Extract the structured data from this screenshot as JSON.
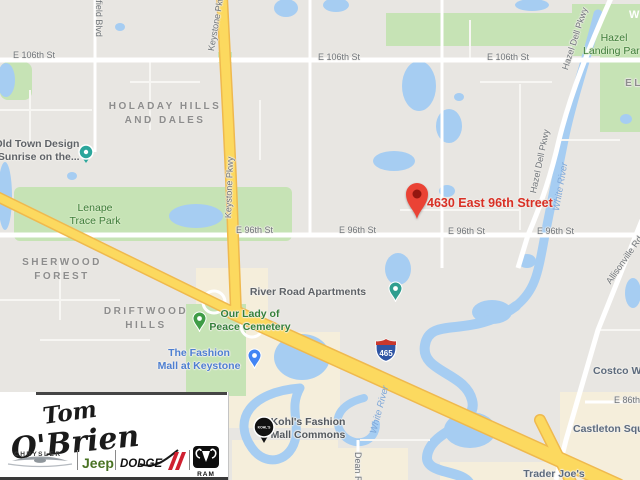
{
  "map": {
    "marker": {
      "label": "4630 East 96th Street",
      "pin_color": "#ea4335",
      "label_color": "#d93025"
    },
    "shield": {
      "route": "465"
    },
    "streets": [
      {
        "t": "E 106th St",
        "x": 13,
        "y": 50
      },
      {
        "t": "E 106th St",
        "x": 318,
        "y": 52
      },
      {
        "t": "E 106th St",
        "x": 487,
        "y": 52
      },
      {
        "t": "E 96th St",
        "x": 236,
        "y": 225
      },
      {
        "t": "E 96th St",
        "x": 339,
        "y": 225
      },
      {
        "t": "E 96th St",
        "x": 448,
        "y": 226
      },
      {
        "t": "E 96th St",
        "x": 537,
        "y": 226
      },
      {
        "t": "E 86th St",
        "x": 614,
        "y": 395
      },
      {
        "t": "Keystone Pkwy",
        "x": 206,
        "y": 50,
        "r": -80
      },
      {
        "t": "Keystone Pkwy",
        "x": 223,
        "y": 218,
        "r": -88
      },
      {
        "t": "Westfield Blvd",
        "x": 104,
        "y": -20,
        "r": 90
      },
      {
        "t": "Hazel Dell Pkwy",
        "x": 560,
        "y": 68,
        "r": -72
      },
      {
        "t": "Hazel Dell Pkwy",
        "x": 528,
        "y": 192,
        "r": -78
      },
      {
        "t": "Allisonville Rd",
        "x": 604,
        "y": 280,
        "r": -55
      },
      {
        "t": "Dean Rd",
        "x": 363,
        "y": 452,
        "r": 90
      }
    ],
    "waters": [
      {
        "t": "White River",
        "x": 551,
        "y": 210,
        "r": -80
      },
      {
        "t": "White River",
        "x": 368,
        "y": 432,
        "r": -75
      }
    ],
    "areas": [
      {
        "lines": [
          "HOLADAY HILLS",
          "AND DALES"
        ],
        "x": 165,
        "y": 100
      },
      {
        "lines": [
          "SHERWOOD",
          "FOREST"
        ],
        "x": 62,
        "y": 256
      },
      {
        "lines": [
          "DRIFTWOOD",
          "HILLS"
        ],
        "x": 146,
        "y": 305
      },
      {
        "lines": [
          "EL"
        ],
        "x": 634,
        "y": 77
      }
    ],
    "parks": [
      {
        "lines": [
          "Lenape",
          "Trace Park"
        ],
        "x": 95,
        "y": 202
      },
      {
        "lines": [
          "Hazel",
          "Landing Park"
        ],
        "x": 614,
        "y": 32
      }
    ],
    "white_label": {
      "t": "W",
      "x": 629,
      "y": 9
    },
    "pois": [
      {
        "lines": [
          "Old Town Design",
          "(Sunrise on the..."
        ],
        "x": 37,
        "y": 138,
        "color": "#5f6368",
        "pin": {
          "kind": "circle",
          "color": "#2ba69b",
          "x": 86,
          "y": 152
        }
      },
      {
        "lines": [
          "River Road Apartments"
        ],
        "x": 308,
        "y": 286,
        "color": "#5f6368",
        "pin": {
          "kind": "drop",
          "color": "#2f9e8f",
          "x": 395,
          "y": 302
        }
      },
      {
        "lines": [
          "Our Lady of",
          "Peace Cemetery"
        ],
        "x": 250,
        "y": 308,
        "color": "#35803b",
        "pin": {
          "kind": "drop",
          "color": "#3f9c46",
          "x": 199,
          "y": 332
        }
      },
      {
        "lines": [
          "The Fashion",
          "Mall at Keystone"
        ],
        "x": 199,
        "y": 347,
        "color": "#4e7fd1",
        "pin": {
          "kind": "drop",
          "color": "#4285f4",
          "x": 254,
          "y": 369
        }
      },
      {
        "lines": [
          "Kohl's Fashion",
          "Mall Commons"
        ],
        "x": 308,
        "y": 416,
        "color": "#54595f",
        "pin": {
          "kind": "kohls",
          "color": "#111111",
          "x": 264,
          "y": 427
        }
      },
      {
        "lines": [
          "Trader Joe's"
        ],
        "x": 554,
        "y": 468,
        "color": "#5d6b7d"
      },
      {
        "lines": [
          "Castleton Square"
        ],
        "x": 573,
        "y": 423,
        "color": "#5d6b7d",
        "align": "left"
      },
      {
        "lines": [
          "Costco Wholesale"
        ],
        "x": 593,
        "y": 365,
        "color": "#5d6b7d",
        "align": "left"
      }
    ],
    "colors": {
      "land": "#e8e6e2",
      "water": "#a6cdf2",
      "park": "#c6e3b5",
      "commercial": "#f5eedb",
      "highway": "#fcd95f",
      "highway_casing": "#efb94e"
    }
  },
  "logo": {
    "line1": "Tom",
    "line2": "O'Brien",
    "chrysler": "CHRYSLER",
    "jeep": "Jeep",
    "dodge": "DODGE",
    "ram": "RAM"
  }
}
